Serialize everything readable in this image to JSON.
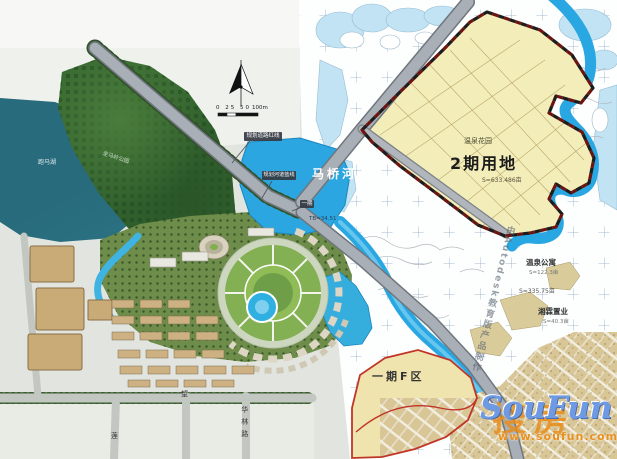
{
  "zones": {
    "phase2": {
      "name": "2期用地",
      "project": "温泉花园",
      "area": "S=633.486亩"
    },
    "phase1f": {
      "name": "一期F区"
    },
    "phase1_tag": "一期"
  },
  "annotations": {
    "road_redline": "规划道路红线",
    "river_blueline": "规划河道蓝线",
    "river": "马桥河",
    "lake": "跑马湖",
    "hill_park": "走马岭公园",
    "wenquan_apartments": "温泉公寓",
    "wenquan_apartments_area": "S=122.3亩",
    "area_mid": "S=335.75亩",
    "xianglin": "湘霖置业",
    "xianglin_area": "S=40.3亩",
    "elevation": "TB=34.51",
    "cad_watermark": "由Autodesk教育版产品制作"
  },
  "roads": {
    "wang": "望",
    "hualin": "华林路",
    "lian": "莲"
  },
  "map_tools": {
    "scale_ticks": "0 25 50",
    "scale_end": "100m",
    "north": "N"
  },
  "watermark": {
    "cn": "搜房",
    "en": "SouFun",
    "url": "www.soufun.com"
  },
  "colors": {
    "phase2_fill": "#f3edba",
    "boundary_red": "#6d1410",
    "river_blue": "#29a7e2",
    "f_zone_outline": "#c13527",
    "lake_teal": "#276b7c"
  }
}
